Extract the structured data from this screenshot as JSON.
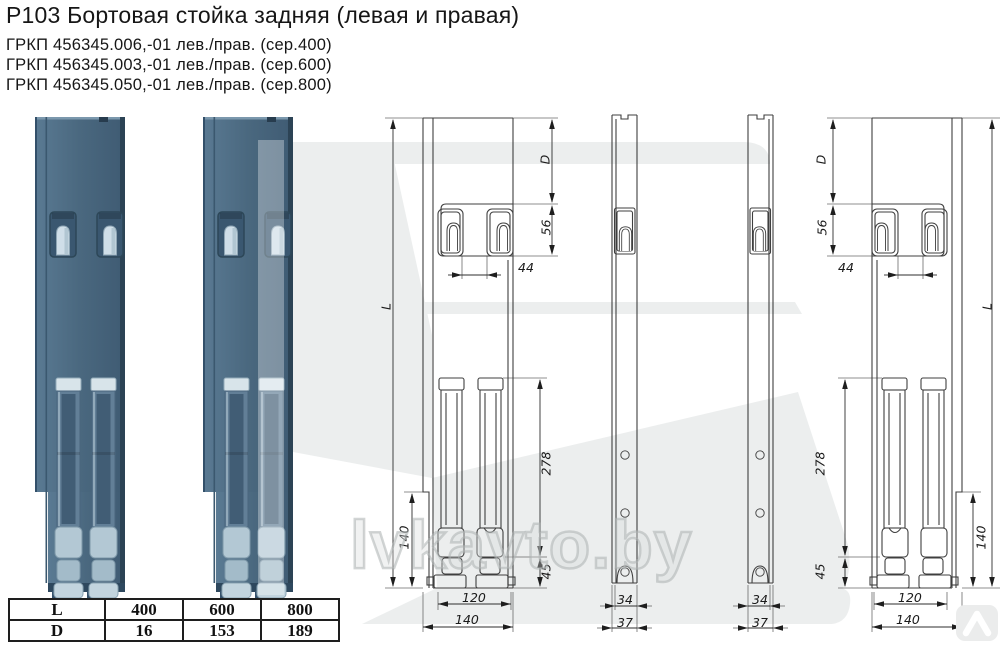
{
  "header": {
    "title": "Р103 Бортовая стойка задняя (левая и правая)",
    "part_numbers": [
      "ГРКП 456345.006,-01 лев./прав. (сер.400)",
      "ГРКП 456345.003,-01 лев./прав. (сер.600)",
      "ГРКП 456345.050,-01 лев./прав. (сер.800)"
    ]
  },
  "dims": {
    "L": "L",
    "D": "D",
    "v56": "56",
    "v44": "44",
    "v278": "278",
    "v45": "45",
    "v140": "140",
    "v120": "120",
    "v34": "34",
    "v37": "37"
  },
  "size_table": {
    "rows": [
      {
        "label": "L",
        "values": [
          "400",
          "600",
          "800"
        ]
      },
      {
        "label": "D",
        "values": [
          "16",
          "153",
          "189"
        ]
      }
    ]
  },
  "watermark": {
    "text": "lvkavto.by"
  },
  "colors": {
    "post_blue": "#4a687f",
    "post_rail_light": "#b3c8d4",
    "watermark_gray": "#e8eaea",
    "drawing_line": "#3f3f3f"
  }
}
